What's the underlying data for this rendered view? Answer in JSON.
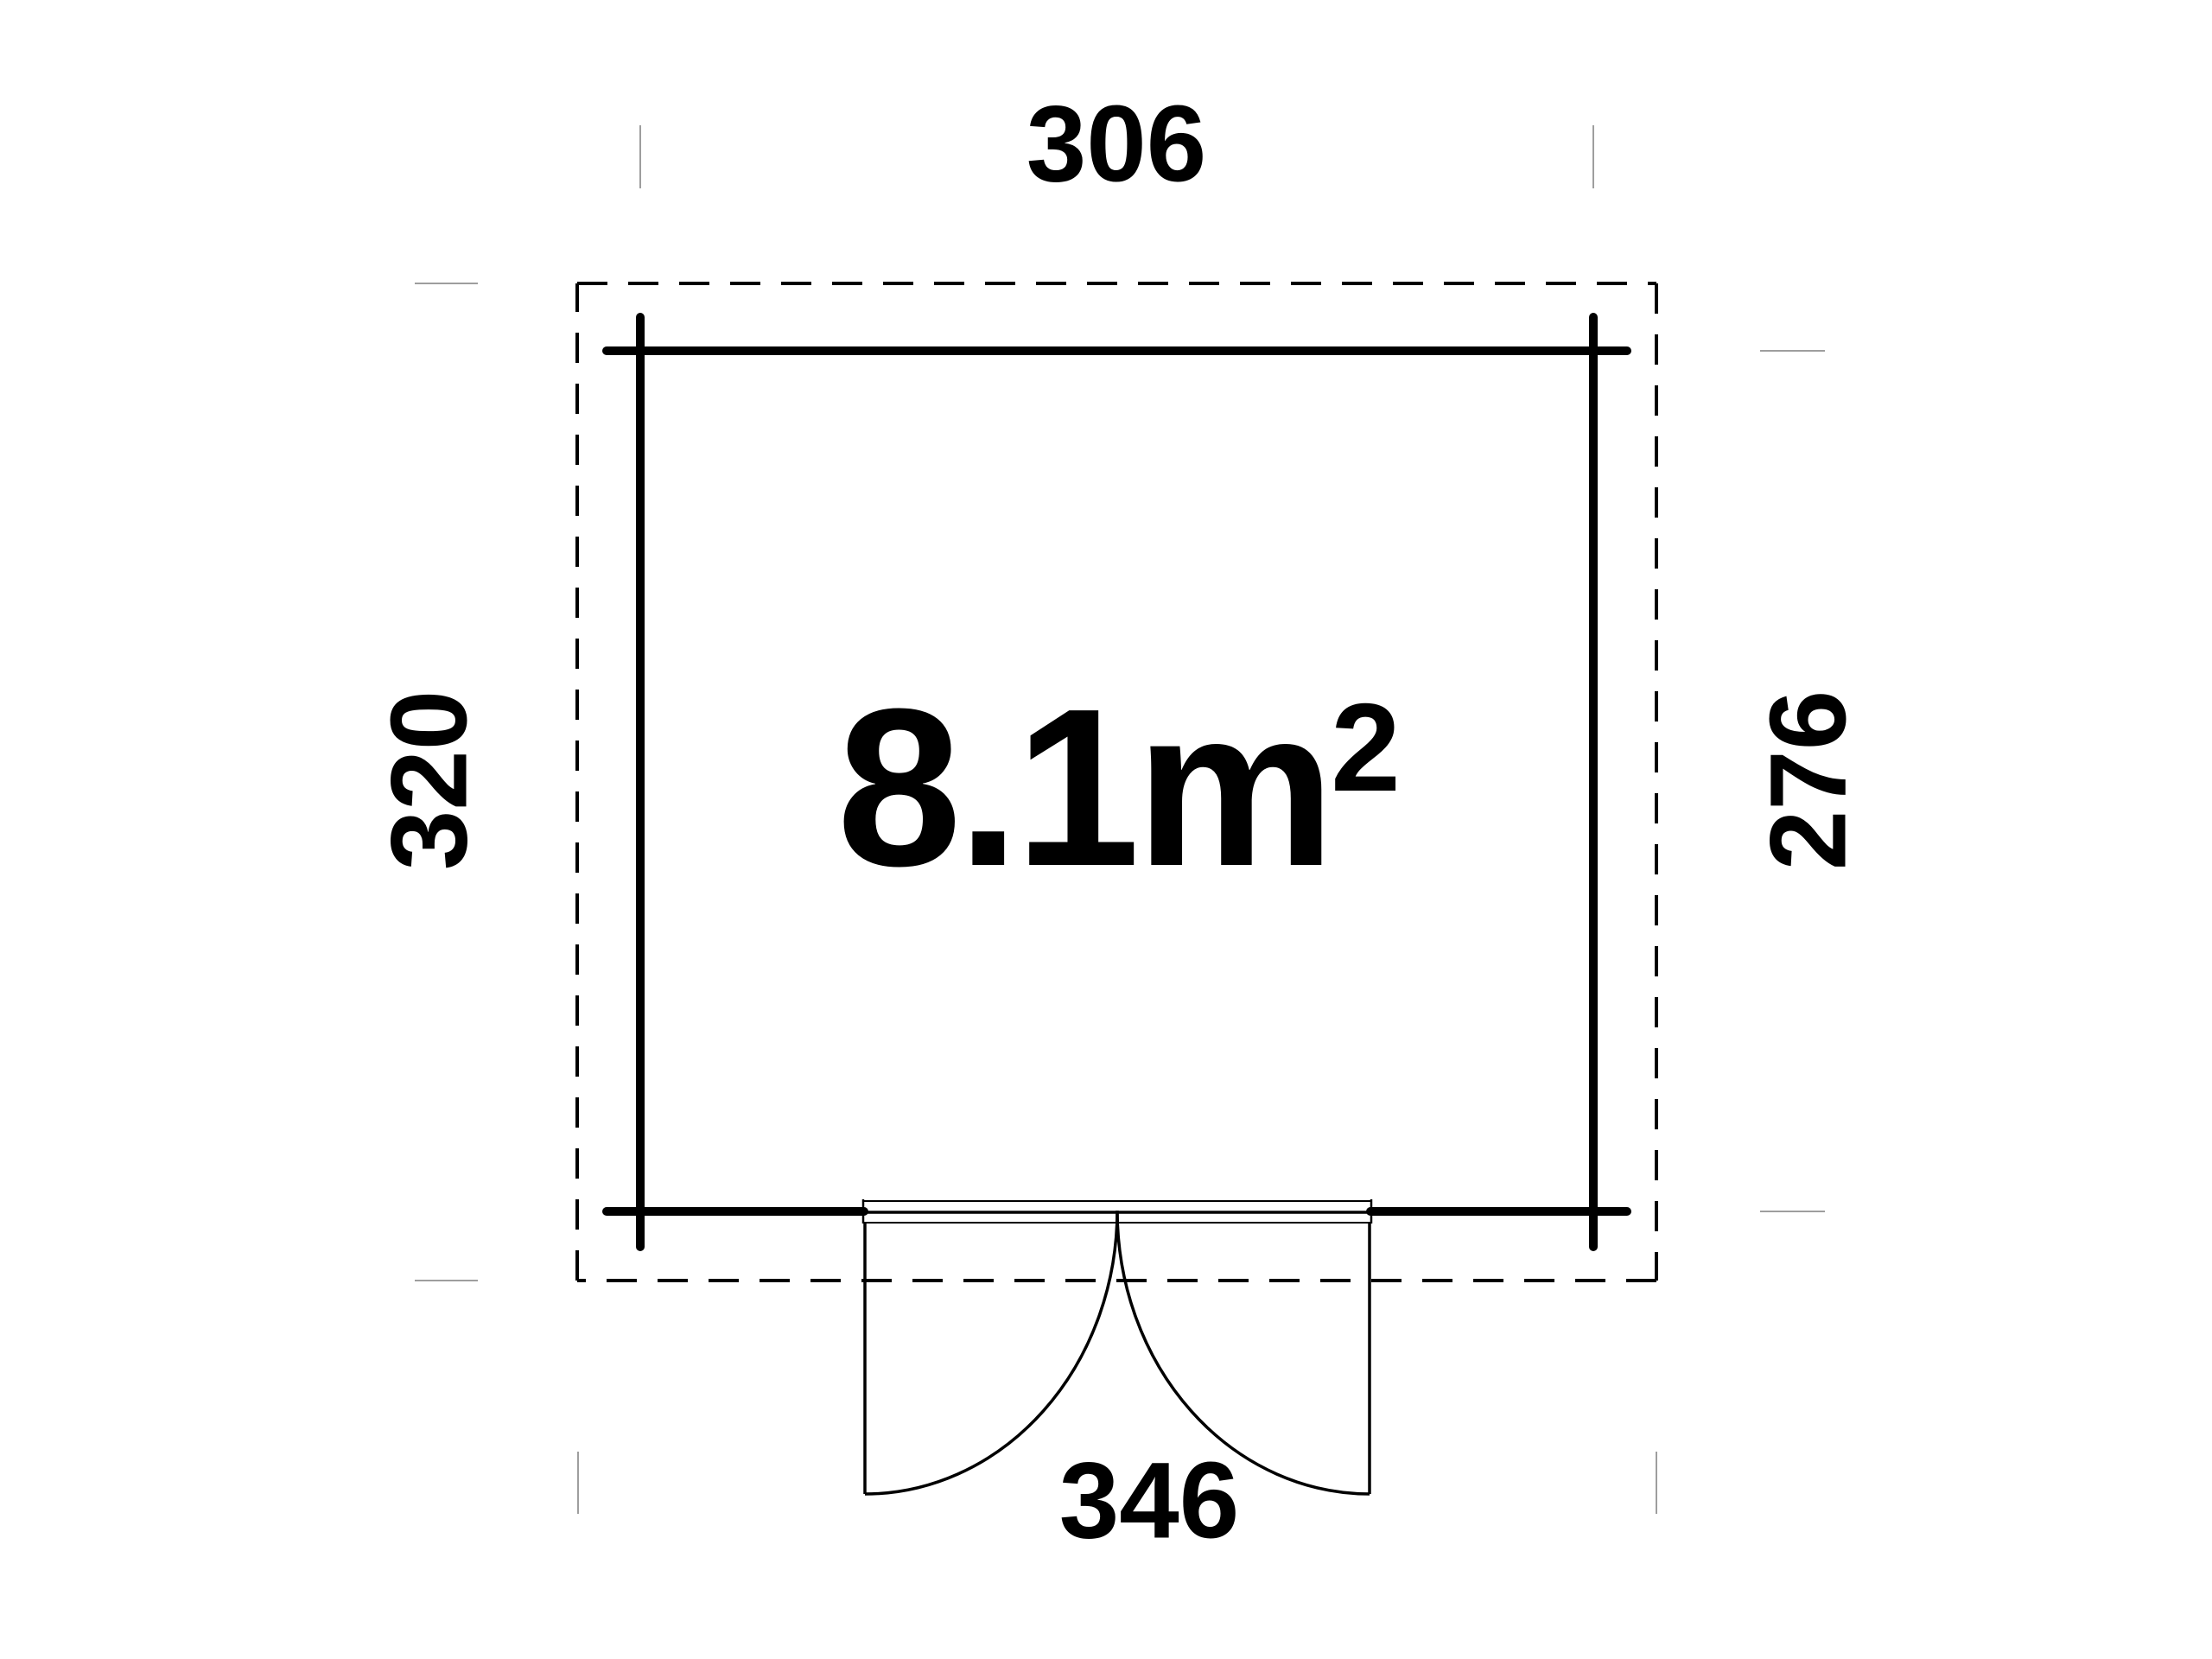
{
  "background": "#ffffff",
  "colors": {
    "line": "#000000",
    "extension_tick": "#9e9e9e",
    "text": "#000000"
  },
  "area": {
    "value": "8.1",
    "unit": "m",
    "exponent": "2"
  },
  "dimensions": {
    "top": "306",
    "left": "320",
    "right": "276",
    "bottom": "346"
  }
}
